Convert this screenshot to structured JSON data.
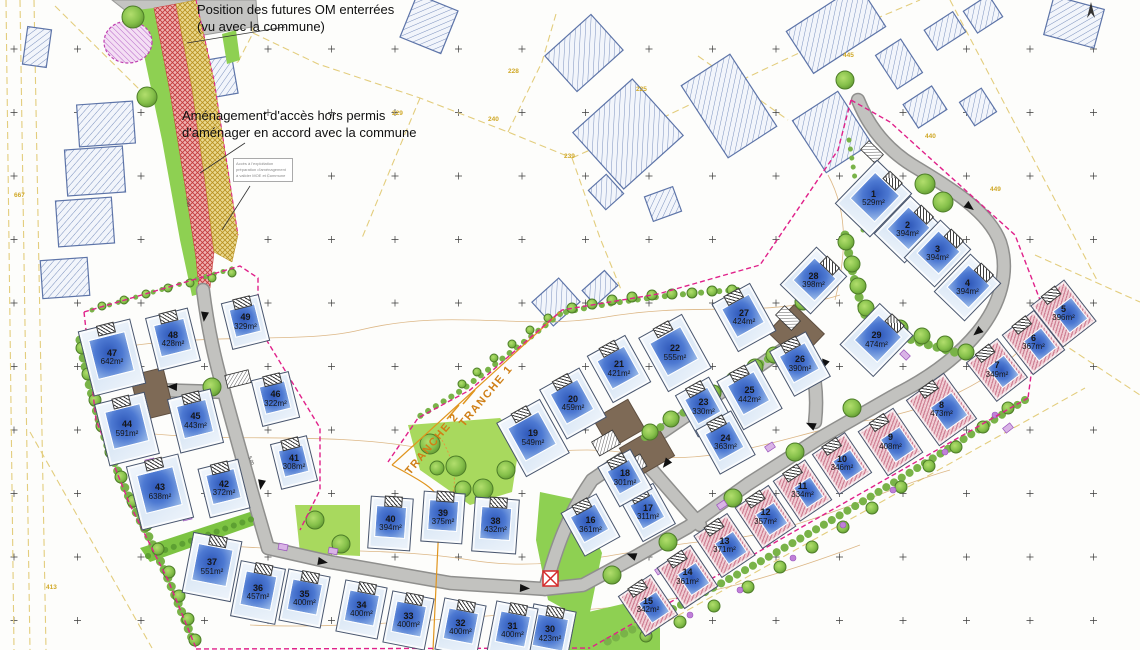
{
  "annotations": {
    "om_note_line1": "Position des futures OM enterrées",
    "om_note_line2": "(vu avec la commune)",
    "access_note_line1": "Aménagement d'accès hors permis",
    "access_note_line2": "d'aménager en accord avec la commune",
    "small_box_lines": [
      "Accès à l'exploitation",
      "préparation d'aménagement",
      "à valider MOE et Commune"
    ],
    "tranche1": "TRANCHE 1",
    "tranche2": "TRANCHE 2"
  },
  "dimension_marks": [
    {
      "text": "3.50",
      "x": 184,
      "y": 200,
      "rot": 82
    },
    {
      "text": "5.00",
      "x": 247,
      "y": 458,
      "rot": 70
    }
  ],
  "colors": {
    "road": "#c2c2bf",
    "road_edge": "#8f8f8d",
    "lot_house_blue": "#4a77cc",
    "lot_pink_stripe": "#cf8195",
    "green": "#8ed052",
    "hedge": "#79b348",
    "boundary_magenta": "#e0218a",
    "cadastral_yellow": "#e3cd7d",
    "tranche_orange": "#e0951e",
    "access_red": "#cc4444",
    "access_khaki": "#b89020",
    "pad_brown": "#7e6a56",
    "building_hatch_blue": "#7a90bd"
  },
  "lots": [
    {
      "num": "1",
      "area": "529m²",
      "x": 872,
      "y": 197,
      "rot": 44,
      "kind": "blue"
    },
    {
      "num": "2",
      "area": "394m²",
      "x": 906,
      "y": 228,
      "rot": 44,
      "kind": "blue"
    },
    {
      "num": "3",
      "area": "394m²",
      "x": 936,
      "y": 252,
      "rot": 44,
      "kind": "blue"
    },
    {
      "num": "4",
      "area": "394m²",
      "x": 966,
      "y": 286,
      "rot": 44,
      "kind": "blue"
    },
    {
      "num": "5",
      "area": "396m²",
      "x": 1062,
      "y": 312,
      "rot": -38,
      "kind": "pink"
    },
    {
      "num": "6",
      "area": "367m²",
      "x": 1032,
      "y": 341,
      "rot": -38,
      "kind": "pink"
    },
    {
      "num": "7",
      "area": "349m²",
      "x": 996,
      "y": 369,
      "rot": -38,
      "kind": "pink"
    },
    {
      "num": "8",
      "area": "473m²",
      "x": 940,
      "y": 408,
      "rot": -36,
      "kind": "pink"
    },
    {
      "num": "9",
      "area": "408m²",
      "x": 889,
      "y": 441,
      "rot": -34,
      "kind": "pink"
    },
    {
      "num": "10",
      "area": "346m²",
      "x": 841,
      "y": 462,
      "rot": -34,
      "kind": "pink"
    },
    {
      "num": "11",
      "area": "334m²",
      "x": 801,
      "y": 489,
      "rot": -34,
      "kind": "pink"
    },
    {
      "num": "12",
      "area": "357m²",
      "x": 764,
      "y": 516,
      "rot": -34,
      "kind": "pink"
    },
    {
      "num": "13",
      "area": "371m²",
      "x": 723,
      "y": 544,
      "rot": -34,
      "kind": "pink"
    },
    {
      "num": "14",
      "area": "361m²",
      "x": 686,
      "y": 576,
      "rot": -34,
      "kind": "pink"
    },
    {
      "num": "15",
      "area": "342m²",
      "x": 647,
      "y": 604,
      "rot": -34,
      "kind": "pink"
    },
    {
      "num": "16",
      "area": "361m²",
      "x": 589,
      "y": 524,
      "rot": -29,
      "kind": "blue"
    },
    {
      "num": "17",
      "area": "311m²",
      "x": 647,
      "y": 511,
      "rot": -29,
      "kind": "blue"
    },
    {
      "num": "18",
      "area": "301m²",
      "x": 624,
      "y": 477,
      "rot": -29,
      "kind": "blue"
    },
    {
      "num": "19",
      "area": "549m²",
      "x": 532,
      "y": 437,
      "rot": -29,
      "kind": "blue"
    },
    {
      "num": "20",
      "area": "459m²",
      "x": 572,
      "y": 402,
      "rot": -29,
      "kind": "blue"
    },
    {
      "num": "21",
      "area": "421m²",
      "x": 618,
      "y": 368,
      "rot": -29,
      "kind": "blue"
    },
    {
      "num": "22",
      "area": "555m²",
      "x": 674,
      "y": 352,
      "rot": -29,
      "kind": "blue"
    },
    {
      "num": "23",
      "area": "330m²",
      "x": 702,
      "y": 406,
      "rot": -29,
      "kind": "blue"
    },
    {
      "num": "24",
      "area": "363m²",
      "x": 724,
      "y": 441,
      "rot": -29,
      "kind": "blue"
    },
    {
      "num": "25",
      "area": "442m²",
      "x": 748,
      "y": 394,
      "rot": -29,
      "kind": "blue"
    },
    {
      "num": "26",
      "area": "390m²",
      "x": 799,
      "y": 363,
      "rot": -29,
      "kind": "blue"
    },
    {
      "num": "27",
      "area": "424m²",
      "x": 743,
      "y": 316,
      "rot": -29,
      "kind": "blue"
    },
    {
      "num": "28",
      "area": "398m²",
      "x": 812,
      "y": 279,
      "rot": 44,
      "kind": "blue"
    },
    {
      "num": "29",
      "area": "474m²",
      "x": 875,
      "y": 339,
      "rot": 44,
      "kind": "blue"
    },
    {
      "num": "30",
      "area": "423m²",
      "x": 549,
      "y": 633,
      "rot": 11,
      "kind": "blue"
    },
    {
      "num": "31",
      "area": "400m²",
      "x": 511,
      "y": 629,
      "rot": 11,
      "kind": "blue"
    },
    {
      "num": "32",
      "area": "400m²",
      "x": 459,
      "y": 626,
      "rot": 11,
      "kind": "blue"
    },
    {
      "num": "33",
      "area": "400m²",
      "x": 407,
      "y": 619,
      "rot": 11,
      "kind": "blue"
    },
    {
      "num": "34",
      "area": "400m²",
      "x": 360,
      "y": 608,
      "rot": 11,
      "kind": "blue"
    },
    {
      "num": "35",
      "area": "400m²",
      "x": 303,
      "y": 597,
      "rot": 11,
      "kind": "blue"
    },
    {
      "num": "36",
      "area": "457m²",
      "x": 257,
      "y": 591,
      "rot": 11,
      "kind": "blue"
    },
    {
      "num": "37",
      "area": "551m²",
      "x": 211,
      "y": 566,
      "rot": 11,
      "kind": "blue"
    },
    {
      "num": "38",
      "area": "432m²",
      "x": 494,
      "y": 524,
      "rot": 4,
      "kind": "blue"
    },
    {
      "num": "39",
      "area": "375m²",
      "x": 442,
      "y": 516,
      "rot": 4,
      "kind": "blue"
    },
    {
      "num": "40",
      "area": "394m²",
      "x": 389,
      "y": 522,
      "rot": 4,
      "kind": "blue"
    },
    {
      "num": "41",
      "area": "308m²",
      "x": 293,
      "y": 461,
      "rot": -14,
      "kind": "blue"
    },
    {
      "num": "42",
      "area": "372m²",
      "x": 223,
      "y": 487,
      "rot": -14,
      "kind": "blue"
    },
    {
      "num": "43",
      "area": "638m²",
      "x": 159,
      "y": 491,
      "rot": -14,
      "kind": "blue"
    },
    {
      "num": "44",
      "area": "591m²",
      "x": 126,
      "y": 428,
      "rot": -14,
      "kind": "blue"
    },
    {
      "num": "45",
      "area": "443m²",
      "x": 194,
      "y": 420,
      "rot": -14,
      "kind": "blue"
    },
    {
      "num": "46",
      "area": "322m²",
      "x": 274,
      "y": 398,
      "rot": -14,
      "kind": "blue"
    },
    {
      "num": "47",
      "area": "642m²",
      "x": 111,
      "y": 356,
      "rot": -14,
      "kind": "blue"
    },
    {
      "num": "48",
      "area": "428m²",
      "x": 172,
      "y": 338,
      "rot": -14,
      "kind": "blue"
    },
    {
      "num": "49",
      "area": "329m²",
      "x": 244,
      "y": 321,
      "rot": -14,
      "kind": "blue"
    }
  ],
  "parcel_numbers": [
    {
      "text": "667",
      "x": 14,
      "y": 192
    },
    {
      "text": "413",
      "x": 46,
      "y": 584
    },
    {
      "text": "229",
      "x": 392,
      "y": 110
    },
    {
      "text": "228",
      "x": 508,
      "y": 68
    },
    {
      "text": "240",
      "x": 488,
      "y": 116
    },
    {
      "text": "225",
      "x": 636,
      "y": 86
    },
    {
      "text": "239",
      "x": 564,
      "y": 153
    },
    {
      "text": "445",
      "x": 843,
      "y": 52
    },
    {
      "text": "440",
      "x": 925,
      "y": 133
    },
    {
      "text": "449",
      "x": 990,
      "y": 186
    }
  ],
  "existing_buildings": [
    [
      106,
      124,
      56,
      42,
      -4
    ],
    [
      95,
      171,
      58,
      46,
      -4
    ],
    [
      85,
      222,
      56,
      46,
      -4
    ],
    [
      65,
      278,
      47,
      38,
      -4
    ],
    [
      37,
      47,
      24,
      38,
      8
    ],
    [
      220,
      77,
      30,
      38,
      -10
    ],
    [
      429,
      24,
      44,
      46,
      22
    ],
    [
      584,
      53,
      62,
      48,
      -42
    ],
    [
      628,
      134,
      80,
      76,
      -42
    ],
    [
      606,
      192,
      24,
      26,
      -42
    ],
    [
      663,
      204,
      30,
      26,
      -20
    ],
    [
      729,
      106,
      58,
      86,
      -33
    ],
    [
      836,
      29,
      86,
      50,
      -33
    ],
    [
      832,
      132,
      54,
      62,
      -33
    ],
    [
      899,
      64,
      30,
      40,
      -33
    ],
    [
      925,
      107,
      34,
      28,
      -33
    ],
    [
      983,
      14,
      30,
      26,
      -33
    ],
    [
      945,
      31,
      34,
      24,
      -33
    ],
    [
      1074,
      22,
      52,
      40,
      15
    ],
    [
      978,
      107,
      26,
      28,
      -33
    ],
    [
      556,
      302,
      36,
      32,
      -42
    ],
    [
      600,
      288,
      30,
      20,
      -42
    ]
  ],
  "trees": [
    [
      133,
      17,
      11
    ],
    [
      147,
      97,
      10
    ],
    [
      845,
      80,
      9
    ],
    [
      925,
      184,
      10
    ],
    [
      943,
      202,
      10
    ],
    [
      846,
      242,
      8
    ],
    [
      852,
      264,
      8
    ],
    [
      858,
      286,
      8
    ],
    [
      866,
      308,
      8
    ],
    [
      880,
      320,
      8
    ],
    [
      900,
      328,
      8
    ],
    [
      922,
      336,
      8
    ],
    [
      945,
      344,
      8
    ],
    [
      966,
      352,
      8
    ],
    [
      650,
      432,
      8
    ],
    [
      671,
      419,
      8
    ],
    [
      692,
      406,
      8
    ],
    [
      713,
      393,
      8
    ],
    [
      734,
      380,
      8
    ],
    [
      755,
      367,
      8
    ],
    [
      774,
      355,
      8
    ],
    [
      572,
      308,
      5
    ],
    [
      592,
      304,
      5
    ],
    [
      612,
      300,
      5
    ],
    [
      632,
      297,
      5
    ],
    [
      652,
      295,
      5
    ],
    [
      672,
      294,
      5
    ],
    [
      692,
      293,
      5
    ],
    [
      712,
      291,
      5
    ],
    [
      732,
      290,
      5
    ],
    [
      548,
      318,
      4
    ],
    [
      530,
      330,
      4
    ],
    [
      512,
      344,
      4
    ],
    [
      494,
      358,
      4
    ],
    [
      477,
      372,
      4
    ],
    [
      462,
      384,
      4
    ],
    [
      430,
      444,
      10
    ],
    [
      456,
      466,
      10
    ],
    [
      483,
      489,
      10
    ],
    [
      506,
      470,
      9
    ],
    [
      437,
      468,
      7
    ],
    [
      315,
      520,
      9
    ],
    [
      341,
      544,
      9
    ],
    [
      463,
      489,
      8
    ],
    [
      852,
      408,
      9
    ],
    [
      795,
      452,
      9
    ],
    [
      733,
      498,
      9
    ],
    [
      668,
      542,
      9
    ],
    [
      612,
      575,
      9
    ],
    [
      1008,
      408,
      6
    ],
    [
      983,
      427,
      6
    ],
    [
      956,
      447,
      6
    ],
    [
      929,
      466,
      6
    ],
    [
      901,
      487,
      6
    ],
    [
      872,
      508,
      6
    ],
    [
      843,
      527,
      6
    ],
    [
      812,
      547,
      6
    ],
    [
      780,
      567,
      6
    ],
    [
      748,
      587,
      6
    ],
    [
      714,
      606,
      6
    ],
    [
      680,
      622,
      6
    ],
    [
      646,
      636,
      6
    ],
    [
      82,
      348,
      6
    ],
    [
      88,
      374,
      6
    ],
    [
      95,
      400,
      6
    ],
    [
      102,
      426,
      6
    ],
    [
      111,
      452,
      6
    ],
    [
      121,
      477,
      6
    ],
    [
      133,
      501,
      6
    ],
    [
      146,
      525,
      6
    ],
    [
      158,
      549,
      6
    ],
    [
      169,
      572,
      6
    ],
    [
      179,
      596,
      6
    ],
    [
      188,
      619,
      6
    ],
    [
      195,
      640,
      6
    ],
    [
      102,
      306,
      4
    ],
    [
      124,
      300,
      4
    ],
    [
      146,
      294,
      4
    ],
    [
      168,
      288,
      4
    ],
    [
      190,
      283,
      4
    ],
    [
      212,
      278,
      4
    ],
    [
      232,
      273,
      4
    ],
    [
      212,
      387,
      9
    ],
    [
      803,
      302,
      8
    ]
  ],
  "flower_dots": [
    [
      995,
      415
    ],
    [
      945,
      452
    ],
    [
      893,
      490
    ],
    [
      843,
      525
    ],
    [
      793,
      558
    ],
    [
      740,
      590
    ],
    [
      690,
      615
    ],
    [
      648,
      632
    ]
  ],
  "utility_boxes": [
    [
      150,
      462,
      -14
    ],
    [
      187,
      517,
      -14
    ],
    [
      283,
      547,
      11
    ],
    [
      333,
      551,
      11
    ],
    [
      660,
      570,
      -34
    ],
    [
      722,
      505,
      -34
    ],
    [
      770,
      447,
      -34
    ],
    [
      582,
      392,
      -29
    ],
    [
      905,
      355,
      44
    ],
    [
      1008,
      428,
      -38
    ]
  ],
  "road_arrows": [
    [
      205,
      312,
      97
    ],
    [
      177,
      387,
      183
    ],
    [
      262,
      480,
      100
    ],
    [
      318,
      561,
      10
    ],
    [
      520,
      588,
      3
    ],
    [
      636,
      557,
      200
    ],
    [
      669,
      460,
      128
    ],
    [
      826,
      360,
      112
    ],
    [
      815,
      427,
      205
    ],
    [
      966,
      204,
      38
    ],
    [
      981,
      329,
      140
    ]
  ],
  "garage_boxes": [
    [
      238,
      379,
      24,
      13,
      -14
    ],
    [
      606,
      443,
      24,
      16,
      -30
    ],
    [
      633,
      466,
      24,
      14,
      -30
    ],
    [
      788,
      318,
      22,
      13,
      44
    ],
    [
      872,
      152,
      20,
      12,
      44
    ]
  ]
}
